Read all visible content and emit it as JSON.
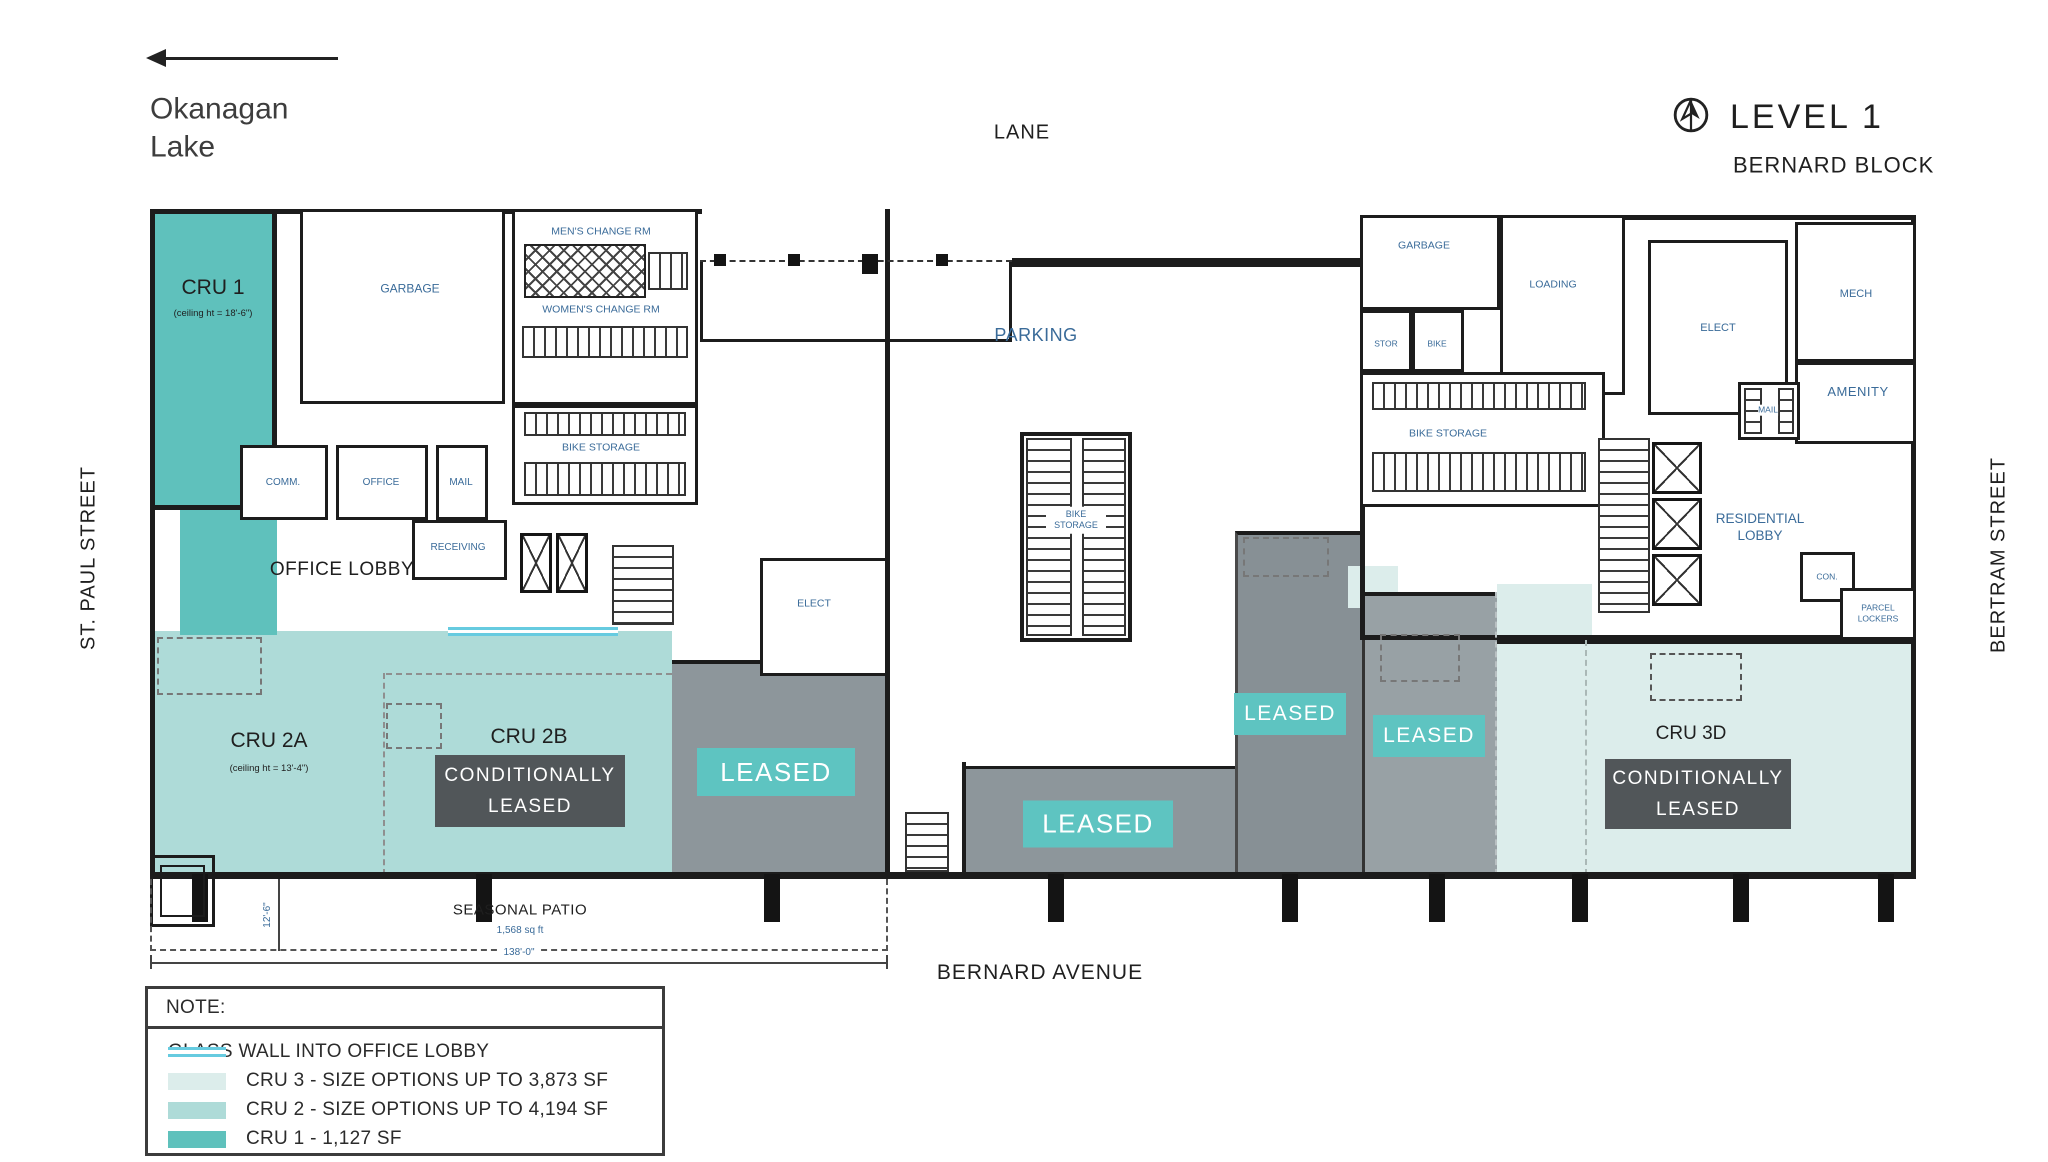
{
  "title": {
    "level": "LEVEL 1",
    "block": "BERNARD BLOCK"
  },
  "landmarks": {
    "lake": "Okanagan Lake"
  },
  "streets": {
    "north": "LANE",
    "west": "ST. PAUL STREET",
    "east": "BERTRAM STREET",
    "south": "BERNARD AVENUE"
  },
  "units": {
    "cru1": {
      "label": "CRU 1",
      "ceiling": "(ceiling ht = 18'-6\")"
    },
    "cru2a": {
      "label": "CRU 2A",
      "ceiling": "(ceiling ht = 13'-4\")"
    },
    "cru2b": {
      "label": "CRU 2B"
    },
    "cru3d": {
      "label": "CRU 3D"
    }
  },
  "badges": {
    "leased": "LEASED",
    "conditionally": "CONDITIONALLY LEASED"
  },
  "rooms": {
    "garbage_west": "GARBAGE",
    "mens_change": "MEN'S CHANGE RM",
    "womens_change": "WOMEN'S CHANGE RM",
    "bike_storage_west": "BIKE STORAGE",
    "comm": "COMM.",
    "office": "OFFICE",
    "mail_west": "MAIL",
    "office_lobby": "OFFICE LOBBY",
    "receiving": "RECEIVING",
    "elect_west": "ELECT",
    "parking": "PARKING",
    "bike_storage_center": "BIKE STORAGE",
    "garbage_east": "GARBAGE",
    "loading": "LOADING",
    "stor": "STOR",
    "bike_east": "BIKE",
    "bike_storage_east": "BIKE STORAGE",
    "elect_east": "ELECT",
    "mech": "MECH",
    "amenity": "AMENITY",
    "mail_east": "MAIL",
    "residential_lobby": "RESIDENTIAL LOBBY",
    "con": "CON.",
    "parcel_lockers": "PARCEL LOCKERS"
  },
  "patio": {
    "label": "SEASONAL PATIO",
    "area": "1,568 sq ft",
    "width_dim": "138'-0\"",
    "depth_dim": "12'-6\""
  },
  "legend": {
    "title": "NOTE:",
    "items": [
      {
        "key": "glass",
        "label": "GLASS WALL INTO OFFICE LOBBY"
      },
      {
        "key": "cru3",
        "label": "CRU 3 - SIZE OPTIONS UP TO 3,873 SF"
      },
      {
        "key": "cru2",
        "label": "CRU 2 - SIZE OPTIONS UP TO 4,194 SF"
      },
      {
        "key": "cru1",
        "label": "CRU 1 - 1,127 SF"
      }
    ]
  },
  "colors": {
    "cru1": "#5fc1bc",
    "cru2": "#aedbd8",
    "cru3": "#dcedeb",
    "leased_zone": "#8d969b",
    "leased_badge": "#5ec4c1",
    "conditional_badge": "#515659",
    "glass_wall": "#66cbe0",
    "wall": "#1c1c1c",
    "room_label": "#3a6b99"
  }
}
